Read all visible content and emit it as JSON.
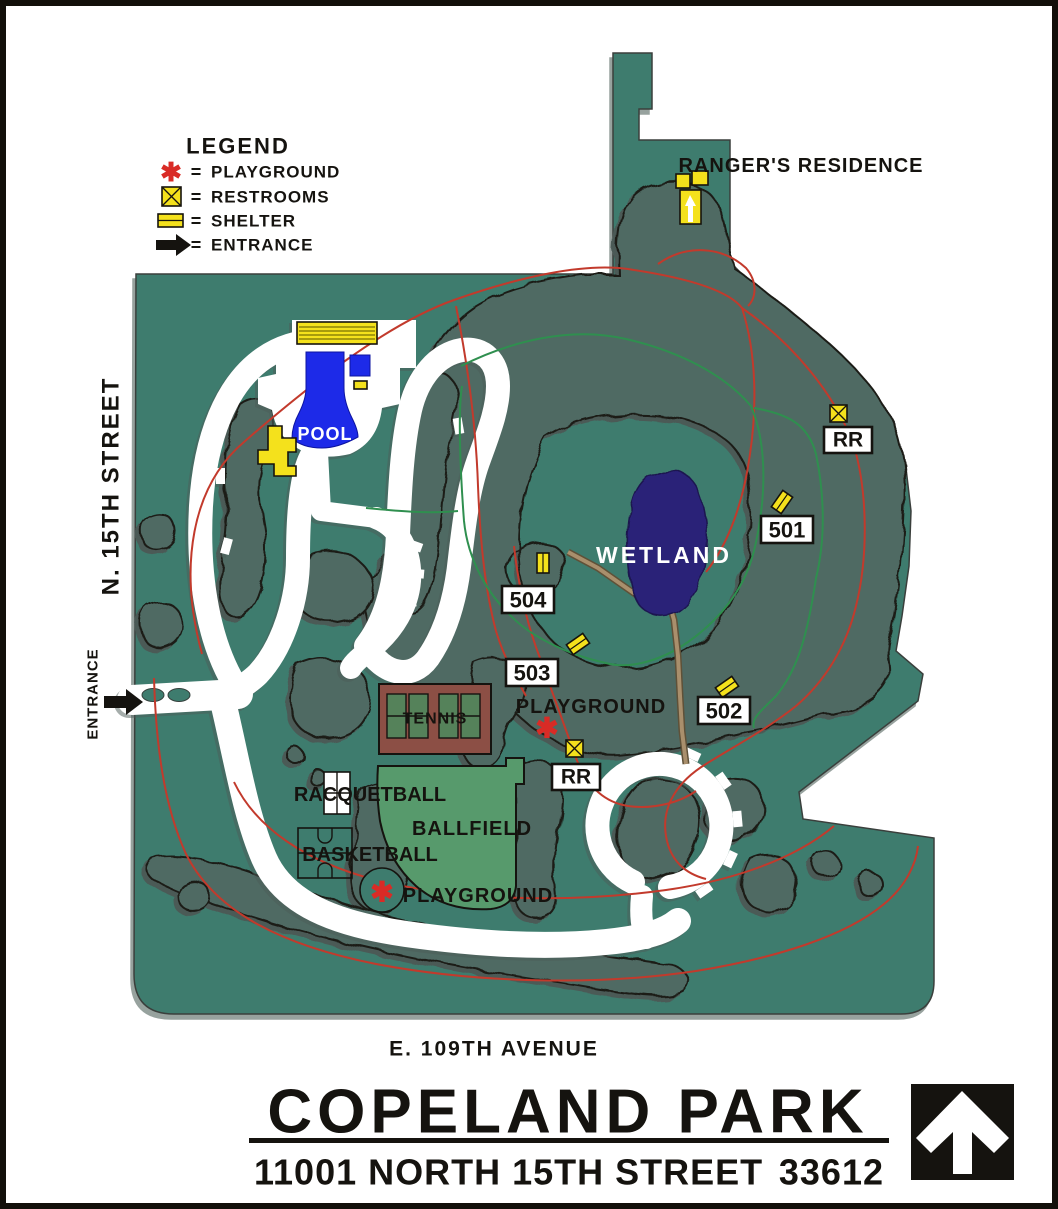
{
  "legend": {
    "title": "LEGEND",
    "eq": "=",
    "items": [
      {
        "icon": "playground-asterisk-icon",
        "label": "PLAYGROUND"
      },
      {
        "icon": "restrooms-icon",
        "label": "RESTROOMS"
      },
      {
        "icon": "shelter-icon",
        "label": "SHELTER"
      },
      {
        "icon": "entrance-arrow-icon",
        "label": "ENTRANCE"
      }
    ]
  },
  "symbols": {
    "playground_glyph": "✱"
  },
  "streets": {
    "west": "N. 15TH STREET",
    "west_entrance": "ENTRANCE",
    "south": "E. 109TH AVENUE"
  },
  "labels": {
    "ranger": "RANGER'S RESIDENCE",
    "pool": "POOL",
    "wetland": "WETLAND",
    "tennis": "TENNIS",
    "racquetball": "RACQUETBALL",
    "basketball": "BASKETBALL",
    "ballfield": "BALLFIELD",
    "playground_upper": "PLAYGROUND",
    "playground_lower": "PLAYGROUND",
    "rr_upper": "RR",
    "rr_lower": "RR",
    "s501": "501",
    "s502": "502",
    "s503": "503",
    "s504": "504"
  },
  "title": {
    "name": "COPELAND PARK",
    "address": "11001 NORTH 15TH STREET",
    "zip": "33612"
  },
  "colors": {
    "park_green": "#3E7C6E",
    "forest_green": "#4F6A63",
    "wetland_navy": "#2A2178",
    "pool_blue": "#1D2AE8",
    "feature_yellow": "#F4E11C",
    "trail_red": "#C23A2C",
    "trail_green": "#2F8F4F",
    "path_brown": "#9B8363",
    "ballfield_green": "#579A6C",
    "tennis_brown": "#8C4F45",
    "playground_red": "#D92B26"
  }
}
